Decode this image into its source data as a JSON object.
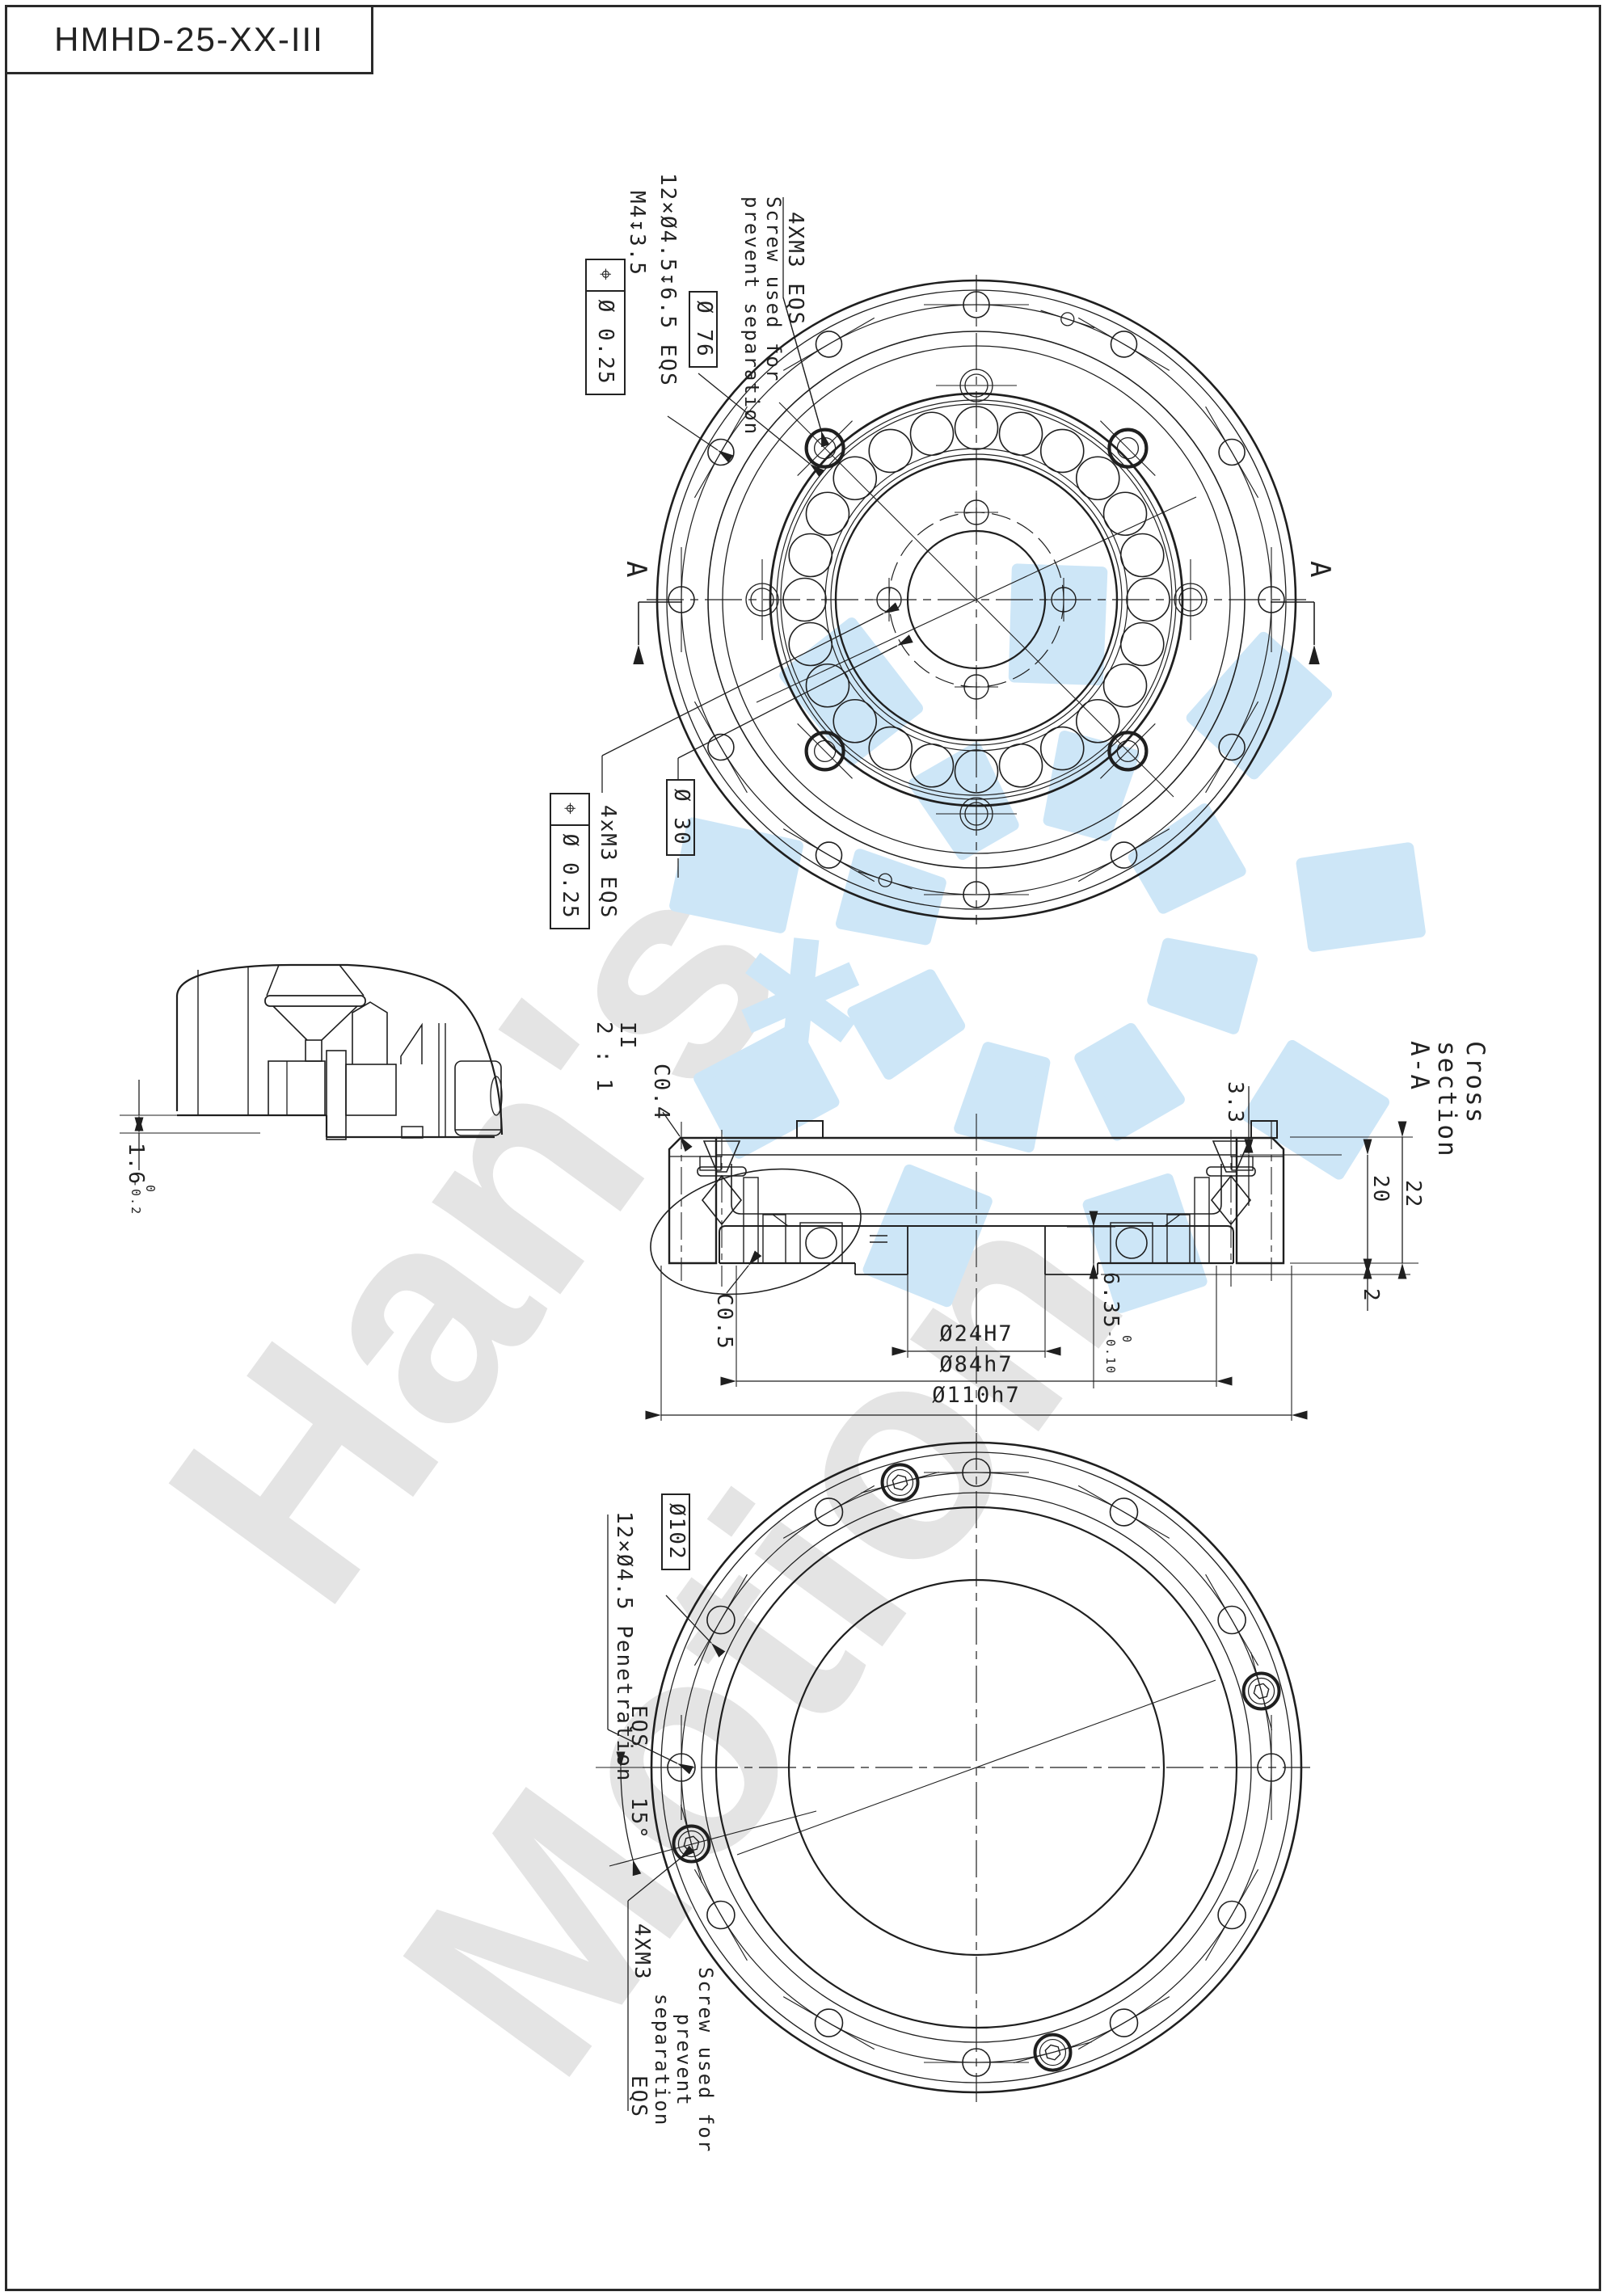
{
  "page": {
    "title": "HMHD-25-XX-III"
  },
  "colors": {
    "line": "#1f1f1f",
    "watermark_text": "#e4e4e4",
    "watermark_logo": "#cde6f7"
  },
  "watermark": {
    "word1": "Han's",
    "word2": "Motion",
    "star": "✱"
  },
  "annotations": {
    "tv_thread": "M4↧3.5",
    "tv_holes": "12×Ø4.5↧6.5 EQS",
    "tv_screw_note": "Screw used for\nprevent separation",
    "tv_4xm3": "4XM3 EQS",
    "fcf_top_sym": "⌖",
    "fcf_top_val": "Ø 0.25",
    "tv_dia76": "Ø 76",
    "tv_dia30": "Ø 30",
    "fcf_bot_sym": "⌖",
    "fcf_bot_val": "Ø 0.25",
    "tv_4xm3_b": "4xM3 EQS",
    "sec_a": "A",
    "cs_title": "Cross section A-A",
    "cs_scale": "II\n2 : 1",
    "cs_c04": "C0.4",
    "cs_c05": "C0.5",
    "cs_d33": "3.3",
    "cs_d20": "20",
    "cs_d22": "22",
    "cs_d2": "2",
    "cs_635": "6.35",
    "cs_635_up": "0",
    "cs_635_dn": "-0.10",
    "cs_d24": "Ø24H7",
    "cs_d84": "Ø84h7",
    "cs_d110": "Ø110h7",
    "dv_16": "1.6",
    "dv_16_up": "0",
    "dv_16_dn": "-0.2",
    "bv_dia102": "Ø102",
    "bv_holes": "12×Ø4.5 Penetration",
    "bv_eqs": "EQS",
    "bv_angle": "15°",
    "bv_4xm3": "4XM3",
    "bv_screw_note": "Screw used for\nprevent\nseparation",
    "bv_eqs2": "EQS"
  }
}
